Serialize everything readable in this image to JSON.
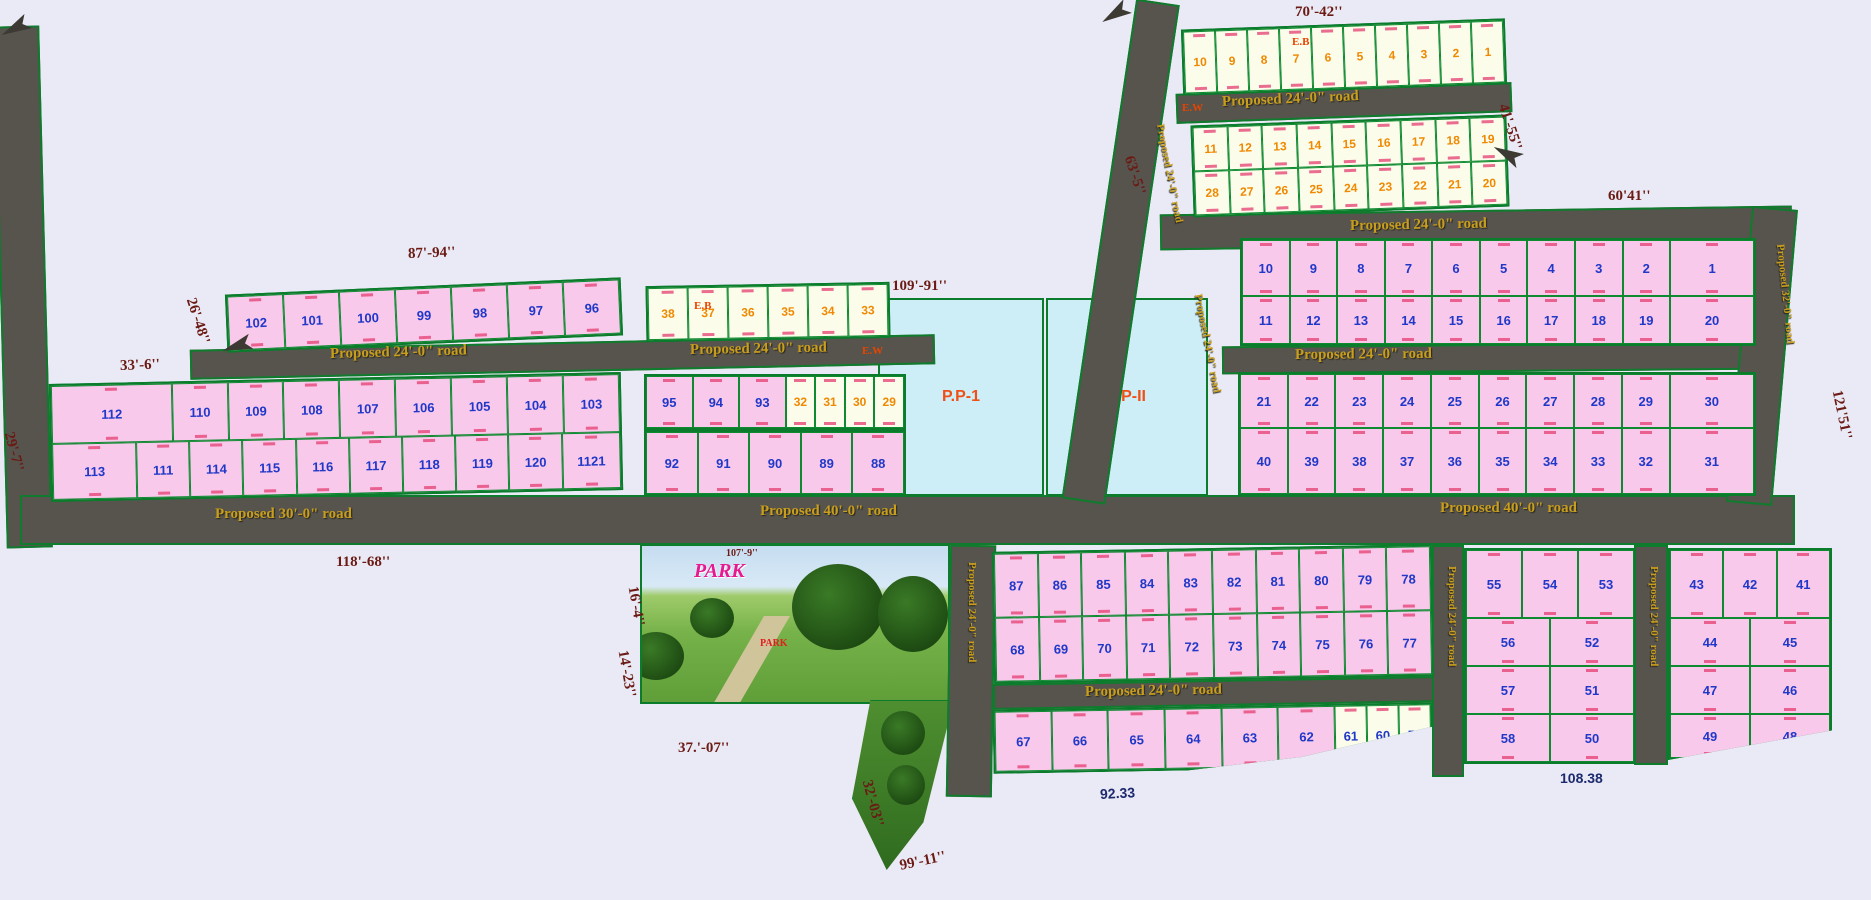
{
  "colors": {
    "background": "#e9eaf5",
    "road_fill": "#57544d",
    "road_border_green": "#0e7c2c",
    "plot_pink": "#f9c9ec",
    "plot_cream": "#fcfceb",
    "pp_cyan": "#cdeef6",
    "number_blue": "#2038c8",
    "number_orange": "#f08800",
    "road_label_gold": "#c99e1c",
    "dimension_maroon": "#6b1a14",
    "dimension_navy": "#1d2a6e",
    "marker_red": "#e84400",
    "park_label_magenta": "#e81890"
  },
  "roads": [
    {
      "id": "left-vertical",
      "x": 0,
      "y": 26,
      "w": 46,
      "h": 522,
      "rot": -1.5
    },
    {
      "id": "main-horizontal",
      "x": 20,
      "y": 495,
      "w": 1775,
      "h": 50,
      "rot": 0
    },
    {
      "id": "upper-middle",
      "x": 190,
      "y": 342,
      "w": 745,
      "h": 30,
      "rot": -1.2
    },
    {
      "id": "top-right-horizontal",
      "x": 1176,
      "y": 88,
      "w": 336,
      "h": 30,
      "rot": -2
    },
    {
      "id": "right-upper",
      "x": 1160,
      "y": 210,
      "w": 632,
      "h": 36,
      "rot": -0.8
    },
    {
      "id": "right-inner",
      "x": 1222,
      "y": 344,
      "w": 540,
      "h": 28,
      "rot": -0.5
    },
    {
      "id": "top-diagonal",
      "x": 1136,
      "y": 2,
      "w": 44,
      "h": 505,
      "rot": 8.5,
      "origin": "top center"
    },
    {
      "id": "far-right-vertical",
      "x": 1752,
      "y": 208,
      "w": 46,
      "h": 297,
      "rot": 5,
      "origin": "top center"
    },
    {
      "id": "bottom-center-vertical",
      "x": 948,
      "y": 545,
      "w": 46,
      "h": 252,
      "rot": 1
    },
    {
      "id": "bottom-inner",
      "x": 993,
      "y": 680,
      "w": 442,
      "h": 26,
      "rot": -1
    },
    {
      "id": "bottom-right-vertical-1",
      "x": 1432,
      "y": 545,
      "w": 32,
      "h": 232,
      "rot": 0
    },
    {
      "id": "bottom-right-vertical-2",
      "x": 1634,
      "y": 545,
      "w": 34,
      "h": 220,
      "rot": 0
    }
  ],
  "road_labels": [
    {
      "text": "Proposed 24'-0\" road",
      "x": 330,
      "y": 346,
      "rot": -1.5
    },
    {
      "text": "Proposed 24'-0\" road",
      "x": 690,
      "y": 342,
      "rot": -1
    },
    {
      "text": "Proposed 30'-0\" road",
      "x": 215,
      "y": 506,
      "rot": 0
    },
    {
      "text": "Proposed 40'-0\" road",
      "x": 760,
      "y": 503,
      "rot": 0
    },
    {
      "text": "Proposed 40'-0\" road",
      "x": 1440,
      "y": 500,
      "rot": 0
    },
    {
      "text": "Proposed 24'-0\" road",
      "x": 1222,
      "y": 94,
      "rot": -2.5
    },
    {
      "text": "Proposed 24'-0\" road",
      "x": 1350,
      "y": 218,
      "rot": -1
    },
    {
      "text": "Proposed 24'-0\" road",
      "x": 1295,
      "y": 347,
      "rot": -0.5
    },
    {
      "text": "Proposed 24'-0\" road",
      "x": 1160,
      "y": 118,
      "rot": 79,
      "small": true
    },
    {
      "text": "Proposed 24'-0\" road",
      "x": 1198,
      "y": 288,
      "rot": 79,
      "small": true
    },
    {
      "text": "Proposed 32'-0\" road",
      "x": 1780,
      "y": 238,
      "rot": 84,
      "small": true
    },
    {
      "text": "Proposed 24'-0\" road",
      "x": 972,
      "y": 556,
      "rot": 90,
      "small": true
    },
    {
      "text": "Proposed 24'-0\" road",
      "x": 1085,
      "y": 684,
      "rot": -1
    },
    {
      "text": "Proposed 24'-0\" road",
      "x": 1452,
      "y": 560,
      "rot": 90,
      "small": true
    },
    {
      "text": "Proposed 24'-0\" road",
      "x": 1654,
      "y": 560,
      "rot": 90,
      "small": true
    }
  ],
  "dimensions": [
    {
      "text": "70'-42''",
      "x": 1295,
      "y": 4,
      "rot": 0
    },
    {
      "text": "41'-55''",
      "x": 1502,
      "y": 96,
      "rot": 72
    },
    {
      "text": "63'-5''",
      "x": 1128,
      "y": 148,
      "rot": 72
    },
    {
      "text": "60'41''",
      "x": 1608,
      "y": 188,
      "rot": 0
    },
    {
      "text": "121'51''",
      "x": 1836,
      "y": 382,
      "rot": 78
    },
    {
      "text": "87'-94''",
      "x": 408,
      "y": 246,
      "rot": -2
    },
    {
      "text": "109'-91''",
      "x": 892,
      "y": 278,
      "rot": 0
    },
    {
      "text": "26'-48''",
      "x": 190,
      "y": 290,
      "rot": 72
    },
    {
      "text": "33'-6''",
      "x": 120,
      "y": 358,
      "rot": -2
    },
    {
      "text": "29'-7''",
      "x": 8,
      "y": 424,
      "rot": 75
    },
    {
      "text": "118'-68''",
      "x": 336,
      "y": 554,
      "rot": 0
    },
    {
      "text": "107'-9''",
      "x": 726,
      "y": 548,
      "rot": 0,
      "tiny": true
    },
    {
      "text": "16'-4''",
      "x": 632,
      "y": 578,
      "rot": 80
    },
    {
      "text": "14'-23''",
      "x": 622,
      "y": 642,
      "rot": 80
    },
    {
      "text": "37.'-07''",
      "x": 678,
      "y": 740,
      "rot": 0
    },
    {
      "text": "32'-03''",
      "x": 866,
      "y": 772,
      "rot": 75
    },
    {
      "text": "99'-11''",
      "x": 900,
      "y": 858,
      "rot": -12
    },
    {
      "text": "92.33",
      "x": 1100,
      "y": 786,
      "rot": -3,
      "navy": true
    },
    {
      "text": "108.38",
      "x": 1560,
      "y": 770,
      "rot": 0,
      "navy": true
    }
  ],
  "markers": [
    {
      "text": "E.W",
      "x": 1182,
      "y": 102
    },
    {
      "text": "E.W",
      "x": 862,
      "y": 345
    },
    {
      "text": "E.B",
      "x": 1292,
      "y": 36
    },
    {
      "text": "E.B",
      "x": 694,
      "y": 300
    }
  ],
  "arrows": [
    {
      "x": 1100,
      "y": 6,
      "rot": -32
    },
    {
      "x": 222,
      "y": 338,
      "rot": -18
    },
    {
      "x": 0,
      "y": 20,
      "rot": -28
    },
    {
      "x": 1492,
      "y": 146,
      "rot": 28
    }
  ],
  "blocks": [
    {
      "id": "top-right-row-a",
      "x": 1182,
      "y": 24,
      "w": 324,
      "h": 66,
      "rot": -2,
      "fill": "cream",
      "nc": "orange",
      "rows": [
        {
          "h": 62,
          "plots": [
            "10",
            "9",
            "8",
            "7",
            "6",
            "5",
            "4",
            "3",
            "2",
            "1"
          ]
        }
      ]
    },
    {
      "id": "top-right-rows-bc",
      "x": 1192,
      "y": 120,
      "w": 316,
      "h": 92,
      "rot": -2,
      "fill": "cream",
      "nc": "orange",
      "rows": [
        {
          "h": 44,
          "plots": [
            "11",
            "12",
            "13",
            "14",
            "15",
            "16",
            "17",
            "18",
            "19"
          ]
        },
        {
          "h": 44,
          "plots": [
            "28",
            "27",
            "26",
            "25",
            "24",
            "23",
            "22",
            "21",
            "20"
          ]
        }
      ]
    },
    {
      "id": "right-main-upper",
      "x": 1240,
      "y": 238,
      "w": 516,
      "h": 108,
      "rot": 0,
      "fill": "pink",
      "nc": "blue",
      "rows": [
        {
          "h": 56,
          "plots": [
            "10",
            "9",
            "8",
            "7",
            "6",
            "5",
            "4",
            "3",
            "2",
            {
              "n": "1",
              "f": 1.8
            }
          ]
        },
        {
          "h": 48,
          "plots": [
            "11",
            "12",
            "13",
            "14",
            "15",
            "16",
            "17",
            "18",
            "19",
            {
              "n": "20",
              "f": 1.8
            }
          ]
        }
      ]
    },
    {
      "id": "right-main-lower",
      "x": 1238,
      "y": 372,
      "w": 518,
      "h": 124,
      "rot": 0,
      "fill": "pink",
      "nc": "blue",
      "rows": [
        {
          "h": 54,
          "plots": [
            "21",
            "22",
            "23",
            "24",
            "25",
            "26",
            "27",
            "28",
            "29",
            {
              "n": "30",
              "f": 1.8
            }
          ]
        },
        {
          "h": 66,
          "plots": [
            "40",
            "39",
            "38",
            "37",
            "36",
            "35",
            "34",
            "33",
            "32",
            {
              "n": "31",
              "f": 1.8
            }
          ]
        }
      ]
    },
    {
      "id": "top-left",
      "x": 226,
      "y": 286,
      "w": 396,
      "h": 58,
      "rot": -2.5,
      "fill": "pink",
      "nc": "blue",
      "rows": [
        {
          "h": 54,
          "plots": [
            "102",
            "101",
            "100",
            "99",
            "98",
            "97",
            "96"
          ]
        }
      ]
    },
    {
      "id": "left-main",
      "x": 50,
      "y": 378,
      "w": 572,
      "h": 118,
      "rot": -1.2,
      "fill": "pink",
      "nc": "blue",
      "rows": [
        {
          "h": 58,
          "plots": [
            {
              "n": "112",
              "f": 2.2
            },
            "110",
            "109",
            "108",
            "107",
            "106",
            "105",
            "104",
            "103"
          ]
        },
        {
          "h": 56,
          "plots": [
            {
              "n": "113",
              "f": 1.6
            },
            "111",
            "114",
            "115",
            "116",
            "117",
            "118",
            "119",
            "120",
            {
              "n": "1121",
              "f": 1.1
            }
          ]
        }
      ]
    },
    {
      "id": "middle-mini-top",
      "x": 646,
      "y": 284,
      "w": 244,
      "h": 56,
      "rot": -1,
      "fill": "cream",
      "nc": "orange",
      "rows": [
        {
          "h": 52,
          "plots": [
            "38",
            "37",
            "36",
            "35",
            "34",
            "33"
          ]
        }
      ]
    },
    {
      "id": "middle-row-95",
      "x": 644,
      "y": 374,
      "w": 262,
      "h": 56,
      "rot": 0,
      "fill": "pink",
      "nc": "blue",
      "rows": [
        {
          "h": 52,
          "plots": [
            "95",
            "94",
            "93",
            {
              "n": "32",
              "f": 0.62,
              "fill": "cream",
              "nc": "orange"
            },
            {
              "n": "31",
              "f": 0.62,
              "fill": "cream",
              "nc": "orange"
            },
            {
              "n": "30",
              "f": 0.62,
              "fill": "cream",
              "nc": "orange"
            },
            {
              "n": "29",
              "f": 0.62,
              "fill": "cream",
              "nc": "orange"
            }
          ]
        }
      ]
    },
    {
      "id": "middle-row-92",
      "x": 644,
      "y": 430,
      "w": 262,
      "h": 66,
      "rot": 0,
      "fill": "pink",
      "nc": "blue",
      "rows": [
        {
          "h": 62,
          "plots": [
            "92",
            "91",
            "90",
            "89",
            "88"
          ]
        }
      ]
    },
    {
      "id": "bottom-middle-upper",
      "x": 993,
      "y": 548,
      "w": 440,
      "h": 132,
      "rot": -1,
      "fill": "pink",
      "nc": "blue",
      "rows": [
        {
          "h": 64,
          "plots": [
            "87",
            "86",
            "85",
            "84",
            "83",
            "82",
            "81",
            "80",
            "79",
            "78"
          ]
        },
        {
          "h": 64,
          "plots": [
            "68",
            "69",
            "70",
            "71",
            "72",
            "73",
            "74",
            "75",
            "76",
            "77"
          ]
        }
      ]
    },
    {
      "id": "bottom-middle-lower",
      "x": 993,
      "y": 706,
      "w": 440,
      "h": 64,
      "rot": -1,
      "fill": "pink",
      "nc": "blue",
      "clip": "polygon(0 0,100% 0,100% 38%,70% 82%,44% 100%,0 100%)",
      "rows": [
        {
          "h": 60,
          "plots": [
            "67",
            "66",
            "65",
            "64",
            "63",
            "62",
            {
              "n": "61",
              "f": 0.55,
              "fill": "cream"
            },
            {
              "n": "60",
              "f": 0.55,
              "fill": "cream"
            },
            {
              "n": "59",
              "f": 0.55,
              "fill": "cream"
            }
          ]
        }
      ]
    },
    {
      "id": "bottom-right-a",
      "x": 1464,
      "y": 548,
      "w": 172,
      "h": 216,
      "rot": 0,
      "fill": "pink",
      "nc": "blue",
      "rows": [
        {
          "h": 68,
          "plots": [
            "55",
            "54",
            "53"
          ]
        },
        {
          "h": 48,
          "plots": [
            "56",
            "52"
          ]
        },
        {
          "h": 48,
          "plots": [
            "57",
            "51"
          ]
        },
        {
          "h": 48,
          "plots": [
            "58",
            "50"
          ]
        }
      ]
    },
    {
      "id": "bottom-right-b",
      "x": 1668,
      "y": 548,
      "w": 164,
      "h": 212,
      "rot": 0,
      "fill": "pink",
      "nc": "blue",
      "clip": "polygon(0 0,100% 0,100% 86%,0 100%)",
      "rows": [
        {
          "h": 68,
          "plots": [
            "43",
            "42",
            "41"
          ]
        },
        {
          "h": 48,
          "plots": [
            "44",
            "45"
          ]
        },
        {
          "h": 48,
          "plots": [
            "47",
            "46"
          ]
        },
        {
          "h": 44,
          "plots": [
            "49",
            "48"
          ]
        }
      ]
    }
  ],
  "pp_areas": [
    {
      "label": "P.P-1",
      "x": 878,
      "y": 298,
      "w": 166,
      "h": 198
    },
    {
      "label": "P.P-II",
      "x": 1046,
      "y": 298,
      "w": 162,
      "h": 198
    }
  ],
  "park": {
    "label": "PARK",
    "sub_label": "PARK"
  }
}
